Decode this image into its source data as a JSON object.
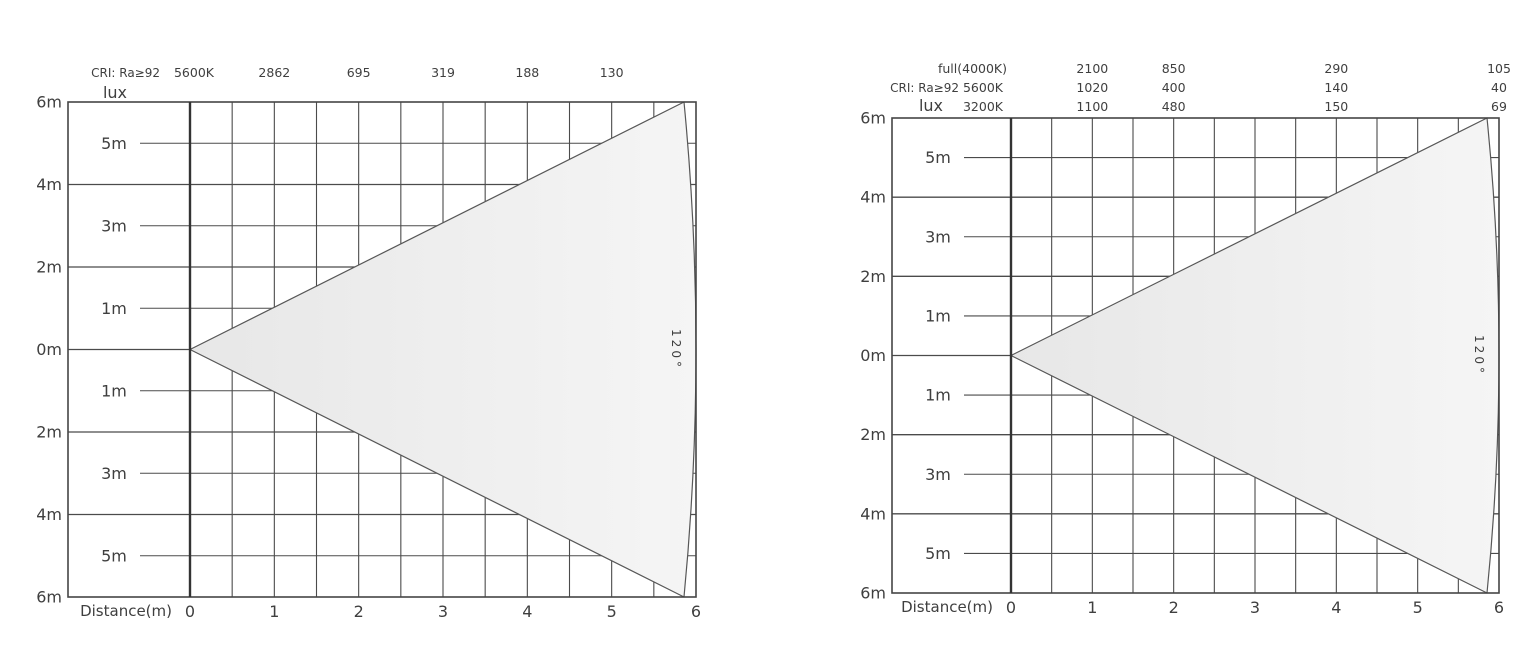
{
  "page": {
    "background": "#ffffff"
  },
  "colors": {
    "grid": "#4b4b4b",
    "border": "#454545",
    "axis": "#333333",
    "text": "#3f3f3f",
    "beam_stroke": "#575757",
    "beam_fill_start": "#e7e7e7",
    "beam_fill_end": "#f5f5f5"
  },
  "chart_data": [
    {
      "type": "area",
      "title": "",
      "xlabel": "Distance(m)",
      "ylabel": "lux",
      "x_range": [
        0,
        6
      ],
      "y_range": [
        -6,
        6
      ],
      "grid": true,
      "beam": {
        "angle_label": "120°",
        "angle_deg": 120,
        "apex_m": [
          0,
          0
        ],
        "reach_m": 6
      },
      "header_rows": [
        {
          "dy": -25,
          "items": [
            {
              "text": "CRI: Ra≥92",
              "anchor": "end",
              "x_px": -30,
              "size": 12
            },
            {
              "text": "5600K",
              "anchor": "middle",
              "x_px": 4,
              "size": 12.5
            },
            {
              "text": "2862",
              "anchor": "middle",
              "x_m": 1,
              "size": 12.5
            },
            {
              "text": "695",
              "anchor": "middle",
              "x_m": 2,
              "size": 12.5
            },
            {
              "text": "319",
              "anchor": "middle",
              "x_m": 3,
              "size": 12.5
            },
            {
              "text": "188",
              "anchor": "middle",
              "x_m": 4,
              "size": 12.5
            },
            {
              "text": "130",
              "anchor": "middle",
              "x_m": 5,
              "size": 12.5
            }
          ]
        },
        {
          "dy": -4,
          "items": [
            {
              "text": "lux",
              "anchor": "middle",
              "x_px": -75,
              "size": 16
            }
          ]
        }
      ],
      "lux_values": {
        "5600K": {
          "1m": 2862,
          "2m": 695,
          "3m": 319,
          "4m": 188,
          "5m": 130
        }
      },
      "y_outer_labels": [
        {
          "m": 6,
          "text": "6m"
        },
        {
          "m": 4,
          "text": "4m"
        },
        {
          "m": 2,
          "text": "2m"
        },
        {
          "m": 0,
          "text": "0m"
        },
        {
          "m": -2,
          "text": "2m"
        },
        {
          "m": -4,
          "text": "4m"
        },
        {
          "m": -6,
          "text": "6m"
        }
      ],
      "y_inner_labels": [
        {
          "m": 5,
          "text": "5m"
        },
        {
          "m": 3,
          "text": "3m"
        },
        {
          "m": 1,
          "text": "1m"
        },
        {
          "m": -1,
          "text": "1m"
        },
        {
          "m": -3,
          "text": "3m"
        },
        {
          "m": -5,
          "text": "5m"
        }
      ],
      "x_ticks": [
        {
          "m": 0,
          "text": "0"
        },
        {
          "m": 1,
          "text": "1"
        },
        {
          "m": 2,
          "text": "2"
        },
        {
          "m": 3,
          "text": "3"
        },
        {
          "m": 4,
          "text": "4"
        },
        {
          "m": 5,
          "text": "5"
        },
        {
          "m": 6,
          "text": "6"
        }
      ],
      "geometry": {
        "left": 68,
        "axis_x": 190,
        "right": 696,
        "top": 102,
        "bottom": 597,
        "arc_inset": 12
      }
    },
    {
      "type": "area",
      "title": "",
      "xlabel": "Distance(m)",
      "ylabel": "lux",
      "x_range": [
        0,
        6
      ],
      "y_range": [
        -6,
        6
      ],
      "grid": true,
      "beam": {
        "angle_label": "120°",
        "angle_deg": 120,
        "apex_m": [
          0,
          0
        ],
        "reach_m": 6
      },
      "header_rows": [
        {
          "dy": -45,
          "items": [
            {
              "text": "full(4000K)",
              "anchor": "end",
              "x_px": -4,
              "size": 12.5
            },
            {
              "text": "2100",
              "anchor": "middle",
              "x_m": 1,
              "size": 12.5
            },
            {
              "text": "850",
              "anchor": "middle",
              "x_m": 2,
              "size": 12.5
            },
            {
              "text": "290",
              "anchor": "middle",
              "x_m": 4,
              "size": 12.5
            },
            {
              "text": "105",
              "anchor": "middle",
              "x_m": 6,
              "size": 12.5
            }
          ]
        },
        {
          "dy": -26,
          "items": [
            {
              "text": "CRI: Ra≥92",
              "anchor": "end",
              "x_px": -52,
              "size": 12
            },
            {
              "text": "5600K",
              "anchor": "end",
              "x_px": -8,
              "size": 12.5
            },
            {
              "text": "1020",
              "anchor": "middle",
              "x_m": 1,
              "size": 12.5
            },
            {
              "text": "400",
              "anchor": "middle",
              "x_m": 2,
              "size": 12.5
            },
            {
              "text": "140",
              "anchor": "middle",
              "x_m": 4,
              "size": 12.5
            },
            {
              "text": "40",
              "anchor": "middle",
              "x_m": 6,
              "size": 12.5
            }
          ]
        },
        {
          "dy": -7,
          "items": [
            {
              "text": "lux",
              "anchor": "middle",
              "x_px": -80,
              "size": 16
            },
            {
              "text": "3200K",
              "anchor": "end",
              "x_px": -8,
              "size": 12.5
            },
            {
              "text": "1100",
              "anchor": "middle",
              "x_m": 1,
              "size": 12.5
            },
            {
              "text": "480",
              "anchor": "middle",
              "x_m": 2,
              "size": 12.5
            },
            {
              "text": "150",
              "anchor": "middle",
              "x_m": 4,
              "size": 12.5
            },
            {
              "text": "69",
              "anchor": "middle",
              "x_m": 6,
              "size": 12.5
            }
          ]
        }
      ],
      "lux_values": {
        "full(4000K)": {
          "1m": 2100,
          "2m": 850,
          "4m": 290,
          "6m": 105
        },
        "5600K": {
          "1m": 1020,
          "2m": 400,
          "4m": 140,
          "6m": 40
        },
        "3200K": {
          "1m": 1100,
          "2m": 480,
          "4m": 150,
          "6m": 69
        }
      },
      "y_outer_labels": [
        {
          "m": 6,
          "text": "6m"
        },
        {
          "m": 4,
          "text": "4m"
        },
        {
          "m": 2,
          "text": "2m"
        },
        {
          "m": 0,
          "text": "0m"
        },
        {
          "m": -2,
          "text": "2m"
        },
        {
          "m": -4,
          "text": "4m"
        },
        {
          "m": -6,
          "text": "6m"
        }
      ],
      "y_inner_labels": [
        {
          "m": 5,
          "text": "5m"
        },
        {
          "m": 3,
          "text": "3m"
        },
        {
          "m": 1,
          "text": "1m"
        },
        {
          "m": -1,
          "text": "1m"
        },
        {
          "m": -3,
          "text": "3m"
        },
        {
          "m": -5,
          "text": "5m"
        }
      ],
      "x_ticks": [
        {
          "m": 0,
          "text": "0"
        },
        {
          "m": 1,
          "text": "1"
        },
        {
          "m": 2,
          "text": "2"
        },
        {
          "m": 3,
          "text": "3"
        },
        {
          "m": 4,
          "text": "4"
        },
        {
          "m": 5,
          "text": "5"
        },
        {
          "m": 6,
          "text": "6"
        }
      ],
      "geometry": {
        "left": 892,
        "axis_x": 1011,
        "right": 1499,
        "top": 118,
        "bottom": 593,
        "arc_inset": 12
      }
    }
  ]
}
